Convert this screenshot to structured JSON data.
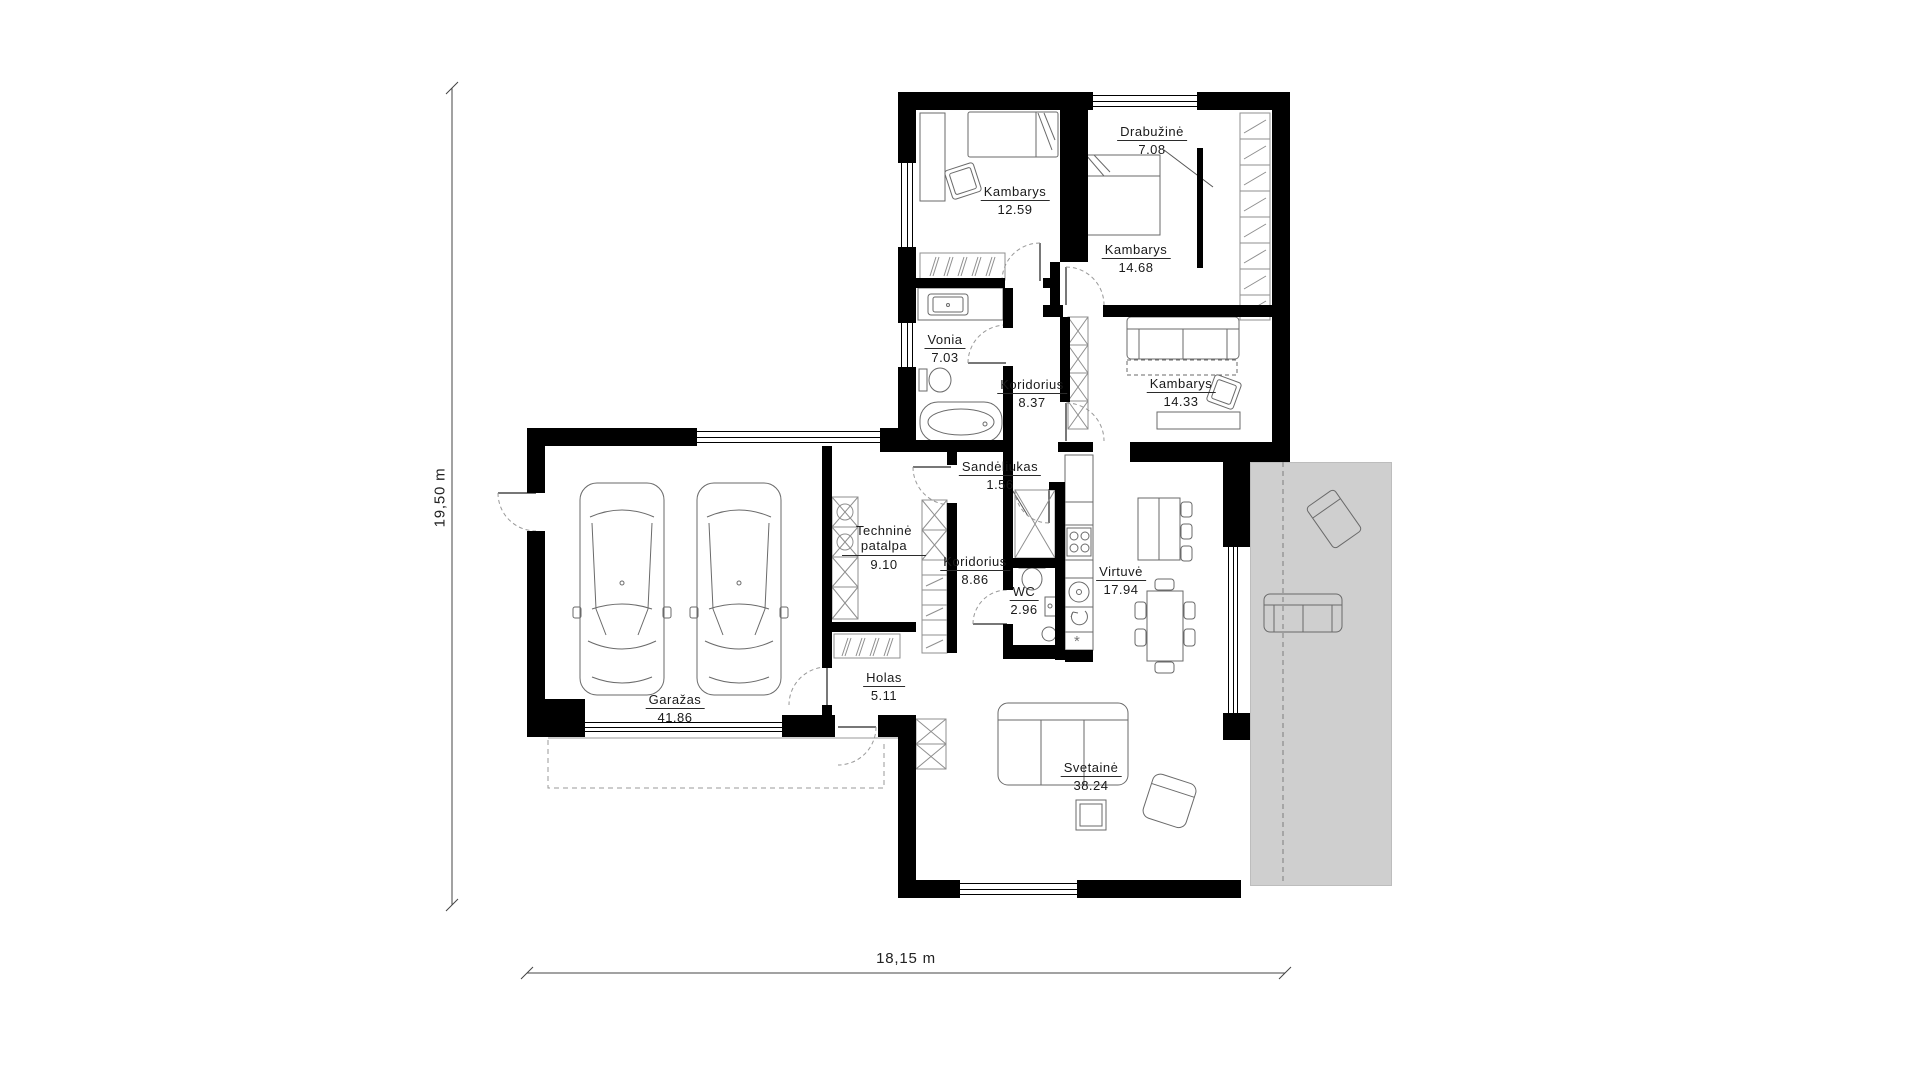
{
  "dimensions": {
    "vertical": "19,50 m",
    "horizontal": "18,15 m"
  },
  "rooms": [
    {
      "id": "kambarys-1",
      "name": "Kambarys",
      "area": "12.59"
    },
    {
      "id": "drabuzine",
      "name": "Drabužinė",
      "area": "7.08"
    },
    {
      "id": "kambarys-2",
      "name": "Kambarys",
      "area": "14.68"
    },
    {
      "id": "vonia",
      "name": "Vonia",
      "area": "7.03"
    },
    {
      "id": "koridorius-1",
      "name": "Koridorius",
      "area": "8.37"
    },
    {
      "id": "kambarys-3",
      "name": "Kambarys",
      "area": "14.33"
    },
    {
      "id": "sandeliukas",
      "name": "Sandėliukas",
      "area": "1.56"
    },
    {
      "id": "technine-patalpa",
      "name": "Techninė patalpa",
      "area": "9.10"
    },
    {
      "id": "koridorius-2",
      "name": "Koridorius",
      "area": "8.86"
    },
    {
      "id": "wc",
      "name": "WC",
      "area": "2.96"
    },
    {
      "id": "virtuve",
      "name": "Virtuvė",
      "area": "17.94"
    },
    {
      "id": "holas",
      "name": "Holas",
      "area": "5.11"
    },
    {
      "id": "garazas",
      "name": "Garažas",
      "area": "41.86"
    },
    {
      "id": "svetaine",
      "name": "Svetainė",
      "area": "38.24"
    }
  ],
  "symbols": {
    "freezer_marker": "*"
  },
  "colors": {
    "wall": "#000000",
    "terrace": "#cfcfcf",
    "furniture_line": "#6a6a6a",
    "hatch_line": "#8f8f8f",
    "door_arc": "#999999",
    "label_text": "#1a1a1a"
  },
  "furniture_icons": [
    "single-bed",
    "desk",
    "chair",
    "wardrobe-rail",
    "double-bed",
    "headboard-shelf",
    "walk-in-closet-shelving",
    "washbasin-counter",
    "toilet",
    "bathtub",
    "storage-x-shelving",
    "sofa-bed",
    "work-desk",
    "kitchen-counter",
    "stove",
    "kitchen-sink",
    "dishwasher",
    "freezer",
    "kitchen-island",
    "bar-stools",
    "dining-table",
    "dining-chairs",
    "corner-sofa",
    "coffee-table",
    "armchair",
    "coat-rack",
    "car",
    "car",
    "terrace-lounge-chair",
    "terrace-bench"
  ]
}
